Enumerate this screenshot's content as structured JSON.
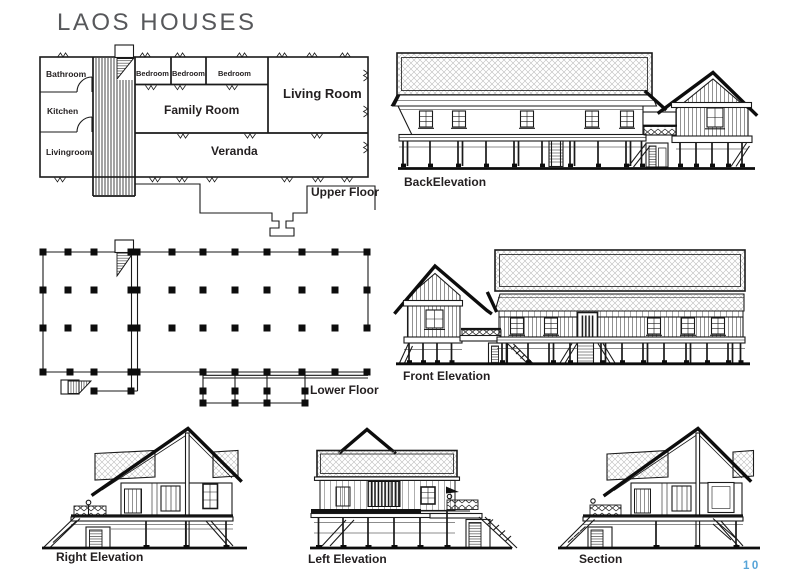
{
  "page": {
    "title": "LAOS HOUSES",
    "page_number": "10"
  },
  "plans": {
    "upper": {
      "caption": "Upper Floor",
      "rooms": {
        "bathroom": "Bathroom",
        "kitchen": "Kitchen",
        "livingroom": "Livingroom",
        "bedroom_1": "Bedroom",
        "bedroom_2": "Bedroom",
        "bedroom_3": "Bedroom",
        "family_room": "Family Room",
        "living_room": "Living Room",
        "veranda": "Veranda"
      }
    },
    "lower": {
      "caption": "Lower Floor"
    }
  },
  "elevations": {
    "back": {
      "caption": "BackElevation"
    },
    "front": {
      "caption": "Front Elevation"
    },
    "right": {
      "caption": "Right Elevation"
    },
    "left": {
      "caption": "Left Elevation"
    },
    "section": {
      "caption": "Section"
    }
  },
  "colors": {
    "ink": "#1a1a1a",
    "title": "#57585b",
    "page_number": "#56a4d8"
  }
}
